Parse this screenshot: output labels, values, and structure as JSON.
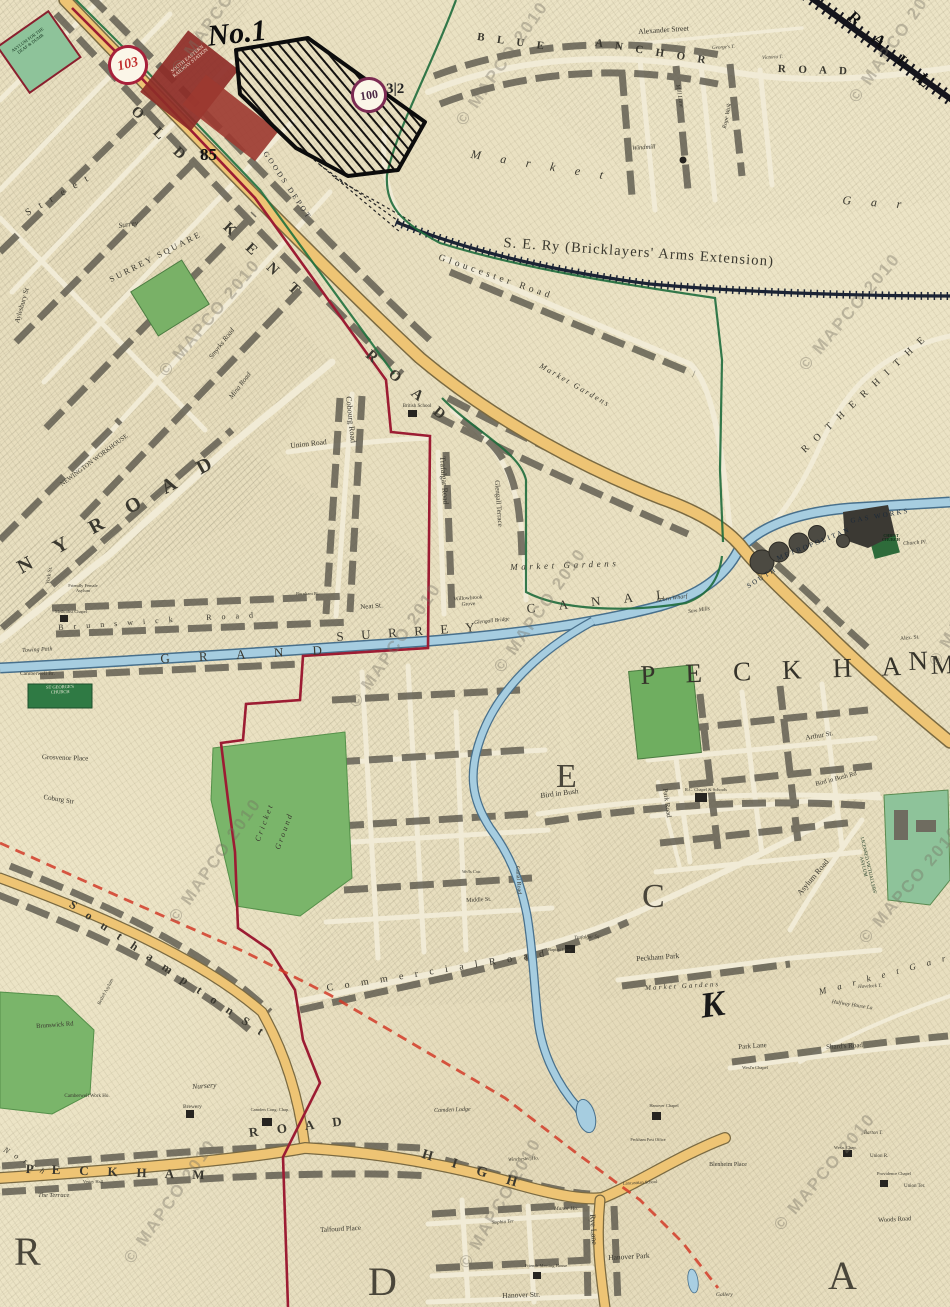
{
  "meta": {
    "watermark_text": "© MAPCO 2010"
  },
  "plates": {
    "left": "103",
    "right": "100"
  },
  "colors": {
    "paper": "#ece4c6",
    "road-yellow": "#eec474",
    "canal-blue": "#a6cde0",
    "park-green": "#7ab56a",
    "boundary-crimson": "#9c1c33",
    "boundary-green": "#1e6b3c",
    "proposed-red": "#d23b28",
    "railway-ink": "#1b2334",
    "station-maroon": "#8e2c28",
    "ink": "#3a382f",
    "plate-red": "#a7203a",
    "plate-purple": "#7b2a52",
    "watermark": "rgba(115,110,98,0.38)"
  },
  "watermarks": [
    {
      "x": 168,
      "y": 66,
      "r": -55
    },
    {
      "x": 452,
      "y": 118,
      "r": -55
    },
    {
      "x": 845,
      "y": 95,
      "r": -55
    },
    {
      "x": 155,
      "y": 368,
      "r": -50
    },
    {
      "x": 795,
      "y": 362,
      "r": -50
    },
    {
      "x": 345,
      "y": 700,
      "r": -55
    },
    {
      "x": 490,
      "y": 665,
      "r": -55
    },
    {
      "x": 925,
      "y": 660,
      "r": -60
    },
    {
      "x": 165,
      "y": 915,
      "r": -55
    },
    {
      "x": 855,
      "y": 935,
      "r": -50
    },
    {
      "x": 120,
      "y": 1256,
      "r": -55
    },
    {
      "x": 455,
      "y": 1262,
      "r": -60
    },
    {
      "x": 770,
      "y": 1222,
      "r": -50
    }
  ],
  "labels": [
    {
      "t": "ASYLUM FOR THE DEAF & DUMB",
      "x": 8,
      "y": 52,
      "r": -36,
      "s": 4.5,
      "c": "#12301c",
      "w": 46
    },
    {
      "t": "SOUTH EASTERN RAILWAY STATION",
      "x": 166,
      "y": 74,
      "r": -39,
      "s": 5,
      "c": "#f6ecd9",
      "w": 52
    },
    {
      "t": "No.1",
      "x": 206,
      "y": 22,
      "r": -6,
      "s": 30,
      "b": 1,
      "i": 1,
      "c": "#0d0d0d"
    },
    {
      "t": "85",
      "x": 200,
      "y": 146,
      "s": 17,
      "b": 1,
      "c": "#111111"
    },
    {
      "t": "3|2",
      "x": 386,
      "y": 82,
      "s": 15,
      "b": 1,
      "c": "#222222"
    },
    {
      "t": "GOODS DEPOT",
      "x": 268,
      "y": 150,
      "r": 56,
      "s": 7.5,
      "sp": 0.35,
      "c": "#2e2e2e"
    },
    {
      "t": "O L D",
      "x": 138,
      "y": 104,
      "r": 44,
      "s": 15,
      "b": 1,
      "sp": 0.5
    },
    {
      "t": "K E N T",
      "x": 230,
      "y": 220,
      "r": 43,
      "s": 15,
      "b": 1,
      "sp": 0.5
    },
    {
      "t": "R O A D",
      "x": 372,
      "y": 348,
      "r": 40,
      "s": 15,
      "b": 1,
      "sp": 0.5
    },
    {
      "t": "S. E. Ry (Bricklayers' Arms  Extension)",
      "x": 504,
      "y": 236,
      "r": 4,
      "s": 14.5,
      "sp": 0.08
    },
    {
      "t": "R A I L",
      "x": 856,
      "y": 8,
      "r": 42,
      "s": 17,
      "b": 1,
      "sp": 0.5,
      "c": "#101010"
    },
    {
      "t": "B L U E",
      "x": 478,
      "y": 32,
      "r": 8,
      "s": 11,
      "b": 1,
      "sp": 0.45
    },
    {
      "t": "A N C H O R",
      "x": 596,
      "y": 38,
      "r": 9,
      "s": 11,
      "b": 1,
      "sp": 0.45
    },
    {
      "t": "R O A D",
      "x": 778,
      "y": 64,
      "r": 2,
      "s": 11,
      "b": 1,
      "sp": 0.45
    },
    {
      "t": "Alexander Street",
      "x": 638,
      "y": 28,
      "r": -4,
      "s": 7.5
    },
    {
      "t": "George's T.",
      "x": 712,
      "y": 46,
      "r": -3,
      "s": 5,
      "i": 1
    },
    {
      "t": "Victoria T.",
      "x": 762,
      "y": 56,
      "r": -3,
      "s": 5,
      "i": 1
    },
    {
      "t": "Rope Walk",
      "x": 722,
      "y": 128,
      "r": -78,
      "s": 6,
      "i": 1
    },
    {
      "t": "Mill Lane",
      "x": 680,
      "y": 84,
      "r": 80,
      "s": 6,
      "i": 1
    },
    {
      "t": "Windmill",
      "x": 632,
      "y": 146,
      "r": -4,
      "s": 6.5,
      "i": 1
    },
    {
      "t": "M a r k e t",
      "x": 472,
      "y": 148,
      "r": 9,
      "s": 12,
      "i": 1,
      "sp": 0.7
    },
    {
      "t": "G a r",
      "x": 843,
      "y": 194,
      "r": 4,
      "s": 12,
      "i": 1,
      "sp": 0.7
    },
    {
      "t": "S t r e e t",
      "x": 24,
      "y": 210,
      "r": -30,
      "s": 10,
      "sp": 0.35
    },
    {
      "t": "Surrey",
      "x": 118,
      "y": 222,
      "r": -8,
      "s": 7.5,
      "i": 1
    },
    {
      "t": "SURREY SQUARE",
      "x": 108,
      "y": 276,
      "r": -27,
      "s": 8.5,
      "sp": 0.3
    },
    {
      "t": "Aylesbury St",
      "x": 14,
      "y": 322,
      "r": -74,
      "s": 7
    },
    {
      "t": "Smyrks Road",
      "x": 208,
      "y": 356,
      "r": -52,
      "s": 7,
      "i": 1
    },
    {
      "t": "Mina Road",
      "x": 228,
      "y": 396,
      "r": -52,
      "s": 7,
      "i": 1
    },
    {
      "t": "Gloucester Road",
      "x": 440,
      "y": 254,
      "r": 19,
      "s": 9.5,
      "sp": 0.4
    },
    {
      "t": "Market Gardens",
      "x": 542,
      "y": 362,
      "r": 30,
      "s": 8,
      "i": 1,
      "sp": 0.25
    },
    {
      "t": "R O T H E R H I T H E",
      "x": 800,
      "y": 448,
      "r": -43,
      "s": 10,
      "sp": 0.35
    },
    {
      "t": "NEWINGTON WORKHOUSE",
      "x": 56,
      "y": 486,
      "r": -37,
      "s": 6.5,
      "w": 92
    },
    {
      "t": "N Y   R O A D",
      "x": 14,
      "y": 560,
      "r": -29,
      "s": 20,
      "b": 1,
      "sp": 0.55
    },
    {
      "t": "Union Road",
      "x": 290,
      "y": 442,
      "r": -6,
      "s": 7.5
    },
    {
      "t": "Cobourg Road",
      "x": 352,
      "y": 396,
      "r": 84,
      "s": 8
    },
    {
      "t": "Trafalgar Road",
      "x": 446,
      "y": 456,
      "r": 86,
      "s": 8
    },
    {
      "t": "Glengall Terrace",
      "x": 500,
      "y": 480,
      "r": 86,
      "s": 7
    },
    {
      "t": "British School",
      "x": 402,
      "y": 404,
      "s": 5,
      "w": 30
    },
    {
      "t": "York St.",
      "x": 46,
      "y": 584,
      "r": -80,
      "s": 5.5
    },
    {
      "t": "Friendly Female Asylum",
      "x": 66,
      "y": 584,
      "s": 4.5,
      "w": 34
    },
    {
      "t": "Methodist Chapel",
      "x": 54,
      "y": 610,
      "s": 4.5,
      "w": 34
    },
    {
      "t": "B r u n s w i c k",
      "x": 58,
      "y": 624,
      "r": -4,
      "s": 8,
      "sp": 0.5
    },
    {
      "t": "R o a d",
      "x": 206,
      "y": 614,
      "r": -3,
      "s": 8,
      "sp": 0.5
    },
    {
      "t": "Burnham Pl.",
      "x": 296,
      "y": 592,
      "s": 4.5
    },
    {
      "t": "Neat St.",
      "x": 360,
      "y": 604,
      "r": -4,
      "s": 7
    },
    {
      "t": "G R A N D",
      "x": 160,
      "y": 652,
      "r": -3,
      "s": 13,
      "sp": 1.0
    },
    {
      "t": "S U R R E Y",
      "x": 336,
      "y": 630,
      "r": -4,
      "s": 13,
      "sp": 0.55
    },
    {
      "t": "C A N A L",
      "x": 526,
      "y": 602,
      "r": -6,
      "s": 13,
      "sp": 0.8
    },
    {
      "t": "Towing Path",
      "x": 22,
      "y": 648,
      "r": -3,
      "s": 6,
      "i": 1
    },
    {
      "t": "Camberwell Br.",
      "x": 20,
      "y": 672,
      "s": 5.5
    },
    {
      "t": "ST GEORGE'S CHURCH",
      "x": 40,
      "y": 686,
      "r": -2,
      "s": 4.5,
      "c": "#f2eedd",
      "w": 40
    },
    {
      "t": "Glengall Bridge",
      "x": 474,
      "y": 621,
      "r": -6,
      "s": 5.5,
      "i": 1
    },
    {
      "t": "Willowbrook Grove",
      "x": 446,
      "y": 598,
      "r": -4,
      "s": 5.5,
      "w": 44
    },
    {
      "t": "Market   Gardens",
      "x": 510,
      "y": 563,
      "r": -2,
      "s": 9,
      "i": 1,
      "sp": 0.4
    },
    {
      "t": "Acorn Wharf",
      "x": 656,
      "y": 598,
      "r": -8,
      "s": 6,
      "i": 1
    },
    {
      "t": "Saw Mills",
      "x": 688,
      "y": 610,
      "r": -8,
      "s": 5.5,
      "i": 1
    },
    {
      "t": "SOUTH",
      "x": 746,
      "y": 584,
      "r": -32,
      "s": 7,
      "sp": 0.3,
      "c": "#1d2a38"
    },
    {
      "t": "METROPOLITAN",
      "x": 776,
      "y": 556,
      "r": -22,
      "s": 7,
      "sp": 0.3,
      "c": "#1d2a38"
    },
    {
      "t": "GAS WORKS",
      "x": 850,
      "y": 518,
      "r": -10,
      "s": 7,
      "sp": 0.3,
      "c": "#1d2a38"
    },
    {
      "t": "CHRIST CHURCH",
      "x": 876,
      "y": 534,
      "s": 4,
      "b": 1,
      "c": "#0e2c16",
      "w": 30
    },
    {
      "t": "Church Pl.",
      "x": 903,
      "y": 542,
      "r": -4,
      "s": 5.5,
      "i": 1
    },
    {
      "t": "Alex. St.",
      "x": 900,
      "y": 637,
      "r": -5,
      "s": 5.5
    },
    {
      "t": "P E C K H A M",
      "x": 640,
      "y": 662,
      "r": -2,
      "s": 27,
      "sp": 0.45,
      "c": "#35332a"
    },
    {
      "t": "N E",
      "x": 908,
      "y": 648,
      "r": -2,
      "s": 27,
      "sp": 0.45,
      "c": "#35332a"
    },
    {
      "t": "Grosvenor Place",
      "x": 42,
      "y": 754,
      "r": 2,
      "s": 7
    },
    {
      "t": "Coburg Str",
      "x": 44,
      "y": 794,
      "r": 9,
      "s": 7
    },
    {
      "t": "Cricket",
      "x": 254,
      "y": 840,
      "r": -70,
      "s": 8,
      "i": 1,
      "sp": 0.3
    },
    {
      "t": "Ground",
      "x": 274,
      "y": 848,
      "r": -70,
      "s": 8,
      "i": 1,
      "sp": 0.3
    },
    {
      "t": "E",
      "x": 556,
      "y": 760,
      "s": 34,
      "c": "#4a463a"
    },
    {
      "t": "C",
      "x": 642,
      "y": 880,
      "s": 34,
      "c": "#4a463a"
    },
    {
      "t": "K",
      "x": 698,
      "y": 988,
      "r": -8,
      "s": 36,
      "b": 1,
      "i": 1,
      "c": "#1a1a1a"
    },
    {
      "t": "R",
      "x": 14,
      "y": 1232,
      "s": 40,
      "c": "#4a463a"
    },
    {
      "t": "D",
      "x": 368,
      "y": 1262,
      "s": 40,
      "c": "#4a463a"
    },
    {
      "t": "A",
      "x": 828,
      "y": 1256,
      "s": 40,
      "c": "#4a463a"
    },
    {
      "t": "Bird in Bush",
      "x": 540,
      "y": 792,
      "r": -7,
      "s": 7.5
    },
    {
      "t": "Bird in Bush Rd",
      "x": 815,
      "y": 782,
      "r": -15,
      "s": 6.5
    },
    {
      "t": "Park Road",
      "x": 668,
      "y": 788,
      "r": 82,
      "s": 7
    },
    {
      "t": "R.C. Chapel & Schools",
      "x": 684,
      "y": 788,
      "s": 4.5,
      "w": 44
    },
    {
      "t": "Arthur St.",
      "x": 805,
      "y": 735,
      "r": -10,
      "s": 7
    },
    {
      "t": "Asylum Road",
      "x": 796,
      "y": 892,
      "r": -50,
      "s": 8
    },
    {
      "t": "LICENSED VICTUALLERS' ASYLUM",
      "x": 862,
      "y": 830,
      "r": 77,
      "s": 4.8,
      "c": "#10301a",
      "w": 72
    },
    {
      "t": "Peckham Park",
      "x": 636,
      "y": 955,
      "r": -4,
      "s": 7.5
    },
    {
      "t": "Market Gardens",
      "x": 645,
      "y": 985,
      "r": -3,
      "s": 7,
      "i": 1,
      "sp": 0.3
    },
    {
      "t": "M a r k e t   G a r",
      "x": 818,
      "y": 988,
      "r": -15,
      "s": 9,
      "i": 1,
      "sp": 0.5
    },
    {
      "t": "Havelock T.",
      "x": 858,
      "y": 985,
      "r": -3,
      "s": 5,
      "i": 1
    },
    {
      "t": "Halfway House La",
      "x": 832,
      "y": 1000,
      "r": 9,
      "s": 5.5,
      "i": 1
    },
    {
      "t": "C o m m e r c i a l   R o a d",
      "x": 326,
      "y": 984,
      "r": -9,
      "s": 10,
      "sp": 0.45
    },
    {
      "t": "Middle St.",
      "x": 466,
      "y": 898,
      "r": -3,
      "s": 6
    },
    {
      "t": "Wells Cott.",
      "x": 462,
      "y": 870,
      "s": 4.5,
      "i": 1
    },
    {
      "t": "Canal Road",
      "x": 520,
      "y": 866,
      "r": 86,
      "s": 6
    },
    {
      "t": "Trafalgar Sq.",
      "x": 574,
      "y": 936,
      "r": -3,
      "s": 5,
      "i": 1
    },
    {
      "t": "Baptist Chap.",
      "x": 548,
      "y": 948,
      "s": 4.5
    },
    {
      "t": "S o u t h a m p t o n   S t",
      "x": 74,
      "y": 898,
      "r": 34,
      "s": 12,
      "b": 1,
      "sp": 0.4
    },
    {
      "t": "Bethel Asylum",
      "x": 96,
      "y": 1006,
      "r": -62,
      "s": 4.8,
      "w": 34
    },
    {
      "t": "Brunswick Rd",
      "x": 36,
      "y": 1024,
      "r": -4,
      "s": 6.5
    },
    {
      "t": "Camberwell Work Ho.",
      "x": 58,
      "y": 1094,
      "s": 5,
      "w": 58
    },
    {
      "t": "Nursery",
      "x": 192,
      "y": 1083,
      "r": -4,
      "s": 7.5,
      "i": 1
    },
    {
      "t": "Brewery",
      "x": 183,
      "y": 1105,
      "s": 5.5
    },
    {
      "t": "Camden Cong. Chap.",
      "x": 248,
      "y": 1108,
      "s": 4.5,
      "w": 44
    },
    {
      "t": "N o r t h",
      "x": 6,
      "y": 1146,
      "r": 30,
      "s": 8,
      "i": 1,
      "sp": 0.3
    },
    {
      "t": "P E C K H A M",
      "x": 26,
      "y": 1162,
      "r": 2,
      "s": 13,
      "b": 1,
      "sp": 0.6
    },
    {
      "t": "R O A D",
      "x": 248,
      "y": 1126,
      "r": -7,
      "s": 13,
      "b": 1,
      "sp": 0.6
    },
    {
      "t": "Vestry Hall",
      "x": 80,
      "y": 1180,
      "s": 4.5,
      "w": 26
    },
    {
      "t": "The Terrace",
      "x": 38,
      "y": 1193,
      "s": 6.5,
      "i": 1
    },
    {
      "t": "Talfourd Place",
      "x": 320,
      "y": 1227,
      "r": -3,
      "s": 7
    },
    {
      "t": "H I G H",
      "x": 424,
      "y": 1148,
      "r": 17,
      "s": 14,
      "b": 1,
      "sp": 0.6
    },
    {
      "t": "Camden Lodge",
      "x": 434,
      "y": 1108,
      "r": -2,
      "s": 6,
      "i": 1
    },
    {
      "t": "Winchester Ho.",
      "x": 508,
      "y": 1158,
      "r": -3,
      "s": 5,
      "i": 1
    },
    {
      "t": "Peckham Post Office",
      "x": 628,
      "y": 1138,
      "s": 4.2,
      "w": 40
    },
    {
      "t": "Lancastrian School",
      "x": 618,
      "y": 1182,
      "r": -3,
      "s": 4.5,
      "w": 44
    },
    {
      "t": "Hanover Chapel",
      "x": 646,
      "y": 1104,
      "s": 4.5,
      "w": 36
    },
    {
      "t": "Blenheim Place",
      "x": 708,
      "y": 1162,
      "s": 6,
      "w": 40
    },
    {
      "t": "Rye Lane",
      "x": 596,
      "y": 1214,
      "r": 86,
      "s": 8
    },
    {
      "t": "Manor Ho.",
      "x": 554,
      "y": 1207,
      "s": 5.5,
      "i": 1
    },
    {
      "t": "Sophia Ter",
      "x": 492,
      "y": 1221,
      "r": -4,
      "s": 5,
      "i": 1
    },
    {
      "t": "Hanover Park",
      "x": 608,
      "y": 1254,
      "r": -3,
      "s": 7.5
    },
    {
      "t": "Friends Meeting House",
      "x": 520,
      "y": 1264,
      "s": 4.5,
      "w": 52
    },
    {
      "t": "Hanover Str.",
      "x": 502,
      "y": 1292,
      "r": -2,
      "s": 7.5
    },
    {
      "t": "Gallery",
      "x": 716,
      "y": 1293,
      "s": 5.5,
      "i": 1
    },
    {
      "t": "Wesl'n Chapel",
      "x": 738,
      "y": 1066,
      "s": 4.5,
      "w": 34
    },
    {
      "t": "Wesn. Chap.",
      "x": 834,
      "y": 1146,
      "s": 4.5
    },
    {
      "t": "Union R.",
      "x": 870,
      "y": 1154,
      "s": 5
    },
    {
      "t": "Providence Chapel",
      "x": 872,
      "y": 1172,
      "s": 4.5,
      "w": 44
    },
    {
      "t": "Union Ter.",
      "x": 904,
      "y": 1184,
      "s": 5
    },
    {
      "t": "Barton T.",
      "x": 864,
      "y": 1131,
      "s": 5,
      "i": 1
    },
    {
      "t": "Woods Road",
      "x": 878,
      "y": 1218,
      "r": -3,
      "s": 6.5
    },
    {
      "t": "Shard's Road",
      "x": 826,
      "y": 1044,
      "r": -3,
      "s": 7
    },
    {
      "t": "Park Lane",
      "x": 738,
      "y": 1044,
      "r": -4,
      "s": 7
    }
  ]
}
